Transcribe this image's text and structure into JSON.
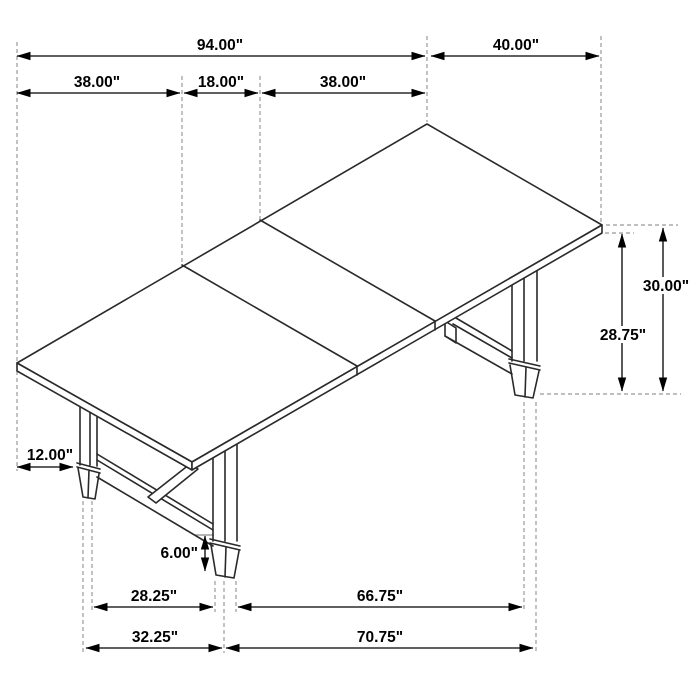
{
  "diagram": {
    "title": "trestle-dining-table-dimension-drawing",
    "subject": "Rectangular extension dining table with trestle legs, isometric line drawing",
    "units": "inches",
    "colors": {
      "background": "#ffffff",
      "drawing_line": "#2a2a2a",
      "dimension_line": "#000000",
      "extension_line": "#999999",
      "label_text": "#000000"
    },
    "dimensions": [
      {
        "id": "overall-length",
        "label": "94.00\"",
        "value": 94.0,
        "unit": "in",
        "orientation": "horizontal",
        "location": "top"
      },
      {
        "id": "overall-width",
        "label": "40.00\"",
        "value": 40.0,
        "unit": "in",
        "orientation": "horizontal",
        "location": "top-right"
      },
      {
        "id": "left-leaf-length",
        "label": "38.00\"",
        "value": 38.0,
        "unit": "in",
        "orientation": "horizontal",
        "location": "top-row-2-left"
      },
      {
        "id": "center-leaf-length",
        "label": "18.00\"",
        "value": 18.0,
        "unit": "in",
        "orientation": "horizontal",
        "location": "top-row-2-center"
      },
      {
        "id": "right-leaf-length",
        "label": "38.00\"",
        "value": 38.0,
        "unit": "in",
        "orientation": "horizontal",
        "location": "top-row-2-right"
      },
      {
        "id": "overall-height",
        "label": "30.00\"",
        "value": 30.0,
        "unit": "in",
        "orientation": "vertical",
        "location": "right"
      },
      {
        "id": "underside-clearance-height",
        "label": "28.75\"",
        "value": 28.75,
        "unit": "in",
        "orientation": "vertical",
        "location": "right-inner"
      },
      {
        "id": "top-overhang",
        "label": "12.00\"",
        "value": 12.0,
        "unit": "in",
        "orientation": "horizontal",
        "location": "left"
      },
      {
        "id": "foot-height",
        "label": "6.00\"",
        "value": 6.0,
        "unit": "in",
        "orientation": "vertical",
        "location": "center-lower"
      },
      {
        "id": "foot-spacing-inner-width",
        "label": "28.25\"",
        "value": 28.25,
        "unit": "in",
        "orientation": "horizontal",
        "location": "bottom-row-1-left"
      },
      {
        "id": "foot-spacing-inner-length",
        "label": "66.75\"",
        "value": 66.75,
        "unit": "in",
        "orientation": "horizontal",
        "location": "bottom-row-1-right"
      },
      {
        "id": "foot-spacing-outer-width",
        "label": "32.25\"",
        "value": 32.25,
        "unit": "in",
        "orientation": "horizontal",
        "location": "bottom-row-2-left"
      },
      {
        "id": "foot-spacing-outer-length",
        "label": "70.75\"",
        "value": 70.75,
        "unit": "in",
        "orientation": "horizontal",
        "location": "bottom-row-2-right"
      }
    ]
  }
}
